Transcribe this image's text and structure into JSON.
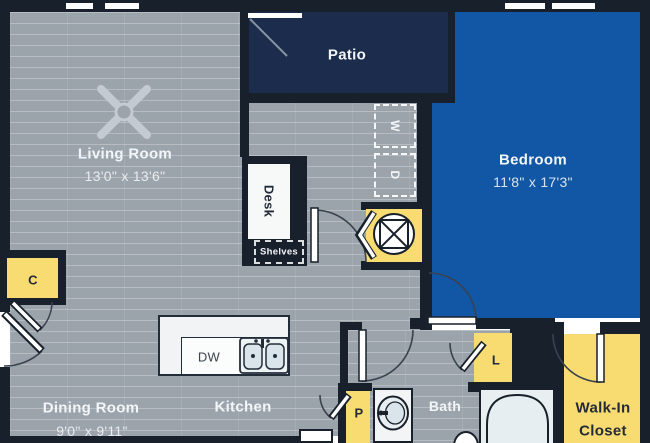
{
  "rooms": {
    "living": {
      "name": "Living Room",
      "dims": "13'0\" x 13'6\""
    },
    "dining": {
      "name": "Dining Room",
      "dims": "9'0\" x 9'11\""
    },
    "kitchen": {
      "name": "Kitchen"
    },
    "bedroom": {
      "name": "Bedroom",
      "dims": "11'8\" x 17'3\""
    },
    "patio": {
      "name": "Patio"
    },
    "bath": {
      "name": "Bath"
    },
    "walk_in": {
      "line1": "Walk-In",
      "line2": "Closet"
    }
  },
  "features": {
    "desk": "Desk",
    "shelves": "Shelves",
    "dishwasher": "DW",
    "washer": "W",
    "dryer": "D",
    "closet_c": "C",
    "closet_l": "L",
    "closet_p": "P"
  },
  "colors": {
    "floor_gray": "#9ba3ab",
    "wall_dark": "#18202c",
    "bedroom_blue": "#1257a6",
    "patio_navy": "#1c2c4c",
    "closet_yellow": "#f8dc72"
  }
}
